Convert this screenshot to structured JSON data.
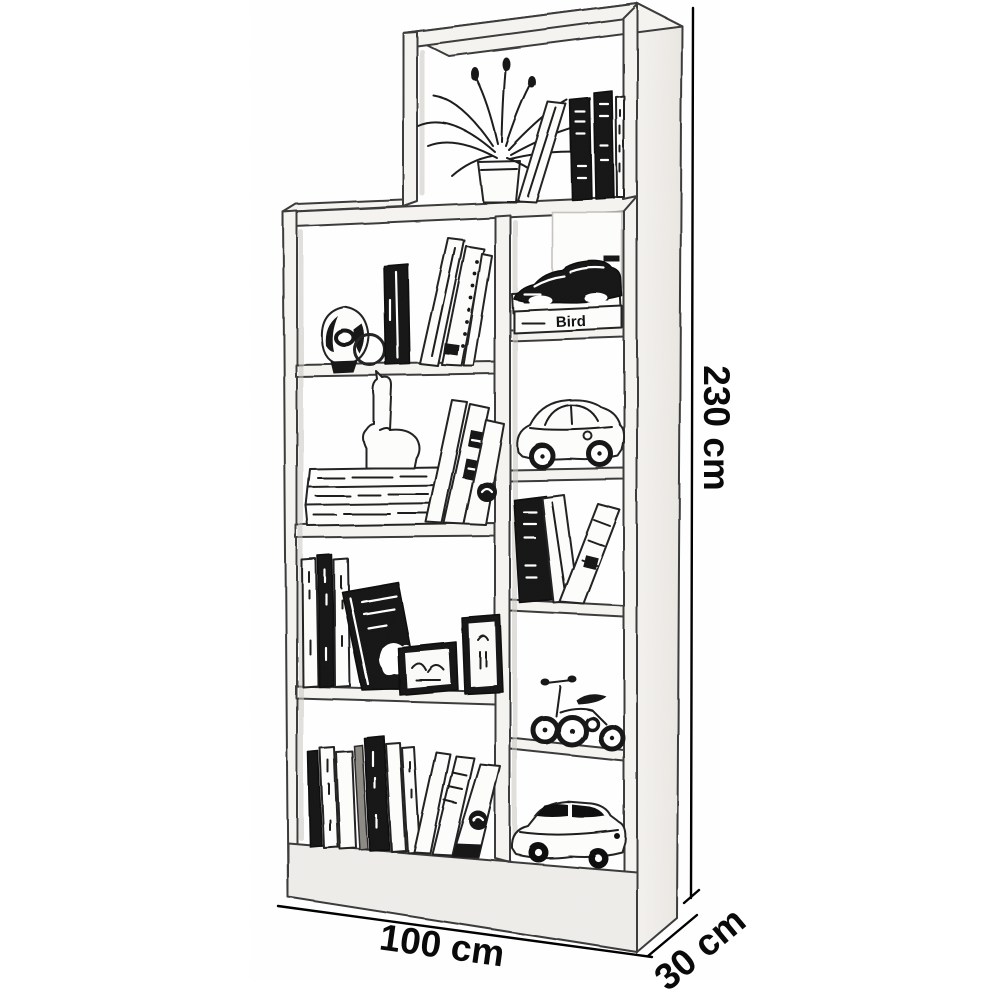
{
  "diagram": {
    "type": "product-dimension-sketch",
    "subject": "staggered cube bookshelf with decor, pencil-sketch style",
    "colors": {
      "background": "#ffffff",
      "line": "#1c1c1c",
      "panel": "#f5f4f1",
      "dimension_text": "#0a0a0a"
    },
    "dimensions": {
      "height_label": "230 cm",
      "width_label": "100 cm",
      "depth_label": "30 cm"
    },
    "labels": {
      "book_spine": "Bird"
    },
    "structure": {
      "left_column_cells": 4,
      "right_column_cells": 5,
      "top_hutch_cells": 1
    },
    "decor_items": [
      {
        "cell": "top-hutch",
        "item": "potted spider plant"
      },
      {
        "cell": "top-hutch",
        "item": "leaning book and row of dark-spined books"
      },
      {
        "cell": "right-1",
        "item": "toy sports car on two stacked books, lower book labeled Bird"
      },
      {
        "cell": "right-2",
        "item": "toy classic car outline"
      },
      {
        "cell": "right-3",
        "item": "dark book with two leaning books"
      },
      {
        "cell": "right-4",
        "item": "toy tricycle"
      },
      {
        "cell": "right-5",
        "item": "toy sedan car"
      },
      {
        "cell": "left-1",
        "item": "abstract sculpture, ring, dark box and leaning books"
      },
      {
        "cell": "left-2",
        "item": "llama figurine on stack of books, leaning books"
      },
      {
        "cell": "left-3",
        "item": "vertical books, dark leaning book, two picture frames"
      },
      {
        "cell": "left-4",
        "item": "row of upright and leaning books"
      }
    ]
  }
}
